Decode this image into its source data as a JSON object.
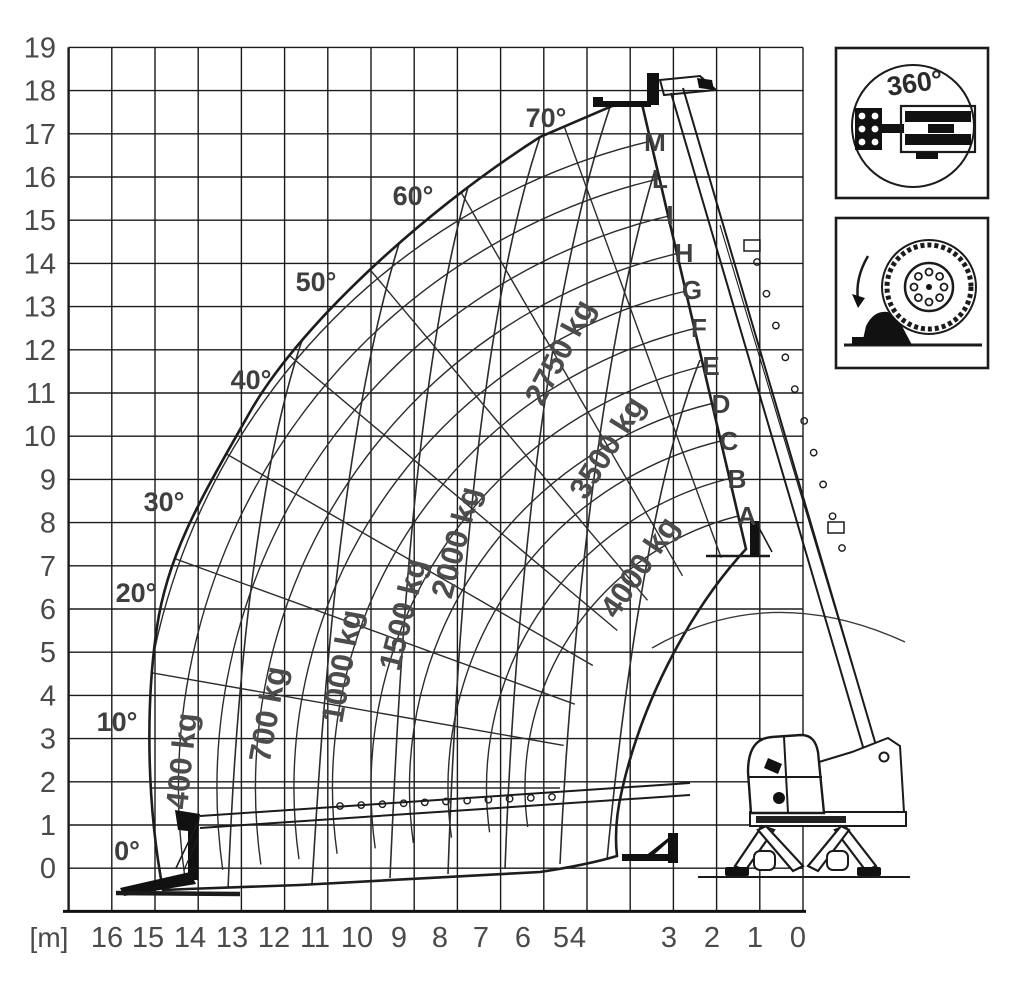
{
  "axes": {
    "unit_label": "[m]",
    "y_ticks": [
      "19",
      "18",
      "17",
      "16",
      "15",
      "14",
      "13",
      "12",
      "11",
      "10",
      "9",
      "8",
      "7",
      "6",
      "5",
      "4",
      "3",
      "2",
      "1",
      "0"
    ],
    "x_ticks": [
      {
        "t": "16",
        "x": 107
      },
      {
        "t": "15",
        "x": 148
      },
      {
        "t": "14",
        "x": 190
      },
      {
        "t": "13",
        "x": 232
      },
      {
        "t": "12",
        "x": 274
      },
      {
        "t": "11",
        "x": 315
      },
      {
        "t": "10",
        "x": 357
      },
      {
        "t": "9",
        "x": 399
      },
      {
        "t": "8",
        "x": 440
      },
      {
        "t": "7",
        "x": 481
      },
      {
        "t": "6",
        "x": 523
      },
      {
        "t": "5",
        "x": 561
      },
      {
        "t": "4",
        "x": 578
      },
      {
        "t": "3",
        "x": 669
      },
      {
        "t": "2",
        "x": 712
      },
      {
        "t": "1",
        "x": 755
      },
      {
        "t": "0",
        "x": 798
      }
    ]
  },
  "angle_labels": [
    {
      "t": "0°",
      "x": 127,
      "y": 860
    },
    {
      "t": "10°",
      "x": 117,
      "y": 731
    },
    {
      "t": "20°",
      "x": 136,
      "y": 602
    },
    {
      "t": "30°",
      "x": 164,
      "y": 511
    },
    {
      "t": "40°",
      "x": 251,
      "y": 389
    },
    {
      "t": "50°",
      "x": 316,
      "y": 291
    },
    {
      "t": "60°",
      "x": 413,
      "y": 205
    },
    {
      "t": "70°",
      "x": 546,
      "y": 127
    }
  ],
  "boom_letters": [
    {
      "t": "M",
      "x": 655,
      "y": 151
    },
    {
      "t": "L",
      "x": 660,
      "y": 188
    },
    {
      "t": "I",
      "x": 670,
      "y": 224
    },
    {
      "t": "H",
      "x": 684,
      "y": 262
    },
    {
      "t": "G",
      "x": 692,
      "y": 299
    },
    {
      "t": "F",
      "x": 699,
      "y": 337
    },
    {
      "t": "E",
      "x": 711,
      "y": 375
    },
    {
      "t": "D",
      "x": 721,
      "y": 413
    },
    {
      "t": "C",
      "x": 729,
      "y": 450
    },
    {
      "t": "B",
      "x": 737,
      "y": 488
    },
    {
      "t": "A",
      "x": 747,
      "y": 525
    }
  ],
  "load_labels": [
    {
      "t": "400 kg",
      "x": 192,
      "y": 762,
      "r": -84
    },
    {
      "t": "700 kg",
      "x": 278,
      "y": 716,
      "r": -80
    },
    {
      "t": "1000 kg",
      "x": 352,
      "y": 668,
      "r": -80
    },
    {
      "t": "1500 kg",
      "x": 413,
      "y": 617,
      "r": -76
    },
    {
      "t": "2000 kg",
      "x": 466,
      "y": 545,
      "r": -75
    },
    {
      "t": "2750 kg",
      "x": 569,
      "y": 357,
      "r": -62
    },
    {
      "t": "3500 kg",
      "x": 616,
      "y": 453,
      "r": -58
    },
    {
      "t": "4000 kg",
      "x": 648,
      "y": 573,
      "r": -56
    }
  ],
  "icons": {
    "rotation_label": "360°",
    "rotation_icon": "telehandler-top-view-360-slew",
    "support_icon": "tyre-with-stabilizer-pad"
  },
  "chart_data": {
    "type": "line",
    "title": "Telescopic handler load capacity diagram (360° slew on stabilizers)",
    "xlabel": "[m]",
    "ylabel": "m",
    "x_axis": {
      "label": "[m]",
      "ticks": [
        16,
        15,
        14,
        13,
        12,
        11,
        10,
        9,
        8,
        7,
        6,
        5,
        4,
        3,
        2,
        1,
        0
      ],
      "direction": "right-to-left"
    },
    "y_axis": {
      "ticks": [
        0,
        1,
        2,
        3,
        4,
        5,
        6,
        7,
        8,
        9,
        10,
        11,
        12,
        13,
        14,
        15,
        16,
        17,
        18,
        19
      ]
    },
    "x_range_m": [
      0,
      16
    ],
    "y_range_m": [
      0,
      19
    ],
    "grid": true,
    "boom_angle_lines_deg": [
      0,
      10,
      20,
      30,
      40,
      50,
      60,
      70
    ],
    "boom_extension_marks": [
      "A",
      "B",
      "C",
      "D",
      "E",
      "F",
      "G",
      "H",
      "I",
      "L",
      "M"
    ],
    "capacity_zones_kg": [
      400,
      700,
      1000,
      1500,
      2000,
      2750,
      3500,
      4000
    ]
  }
}
